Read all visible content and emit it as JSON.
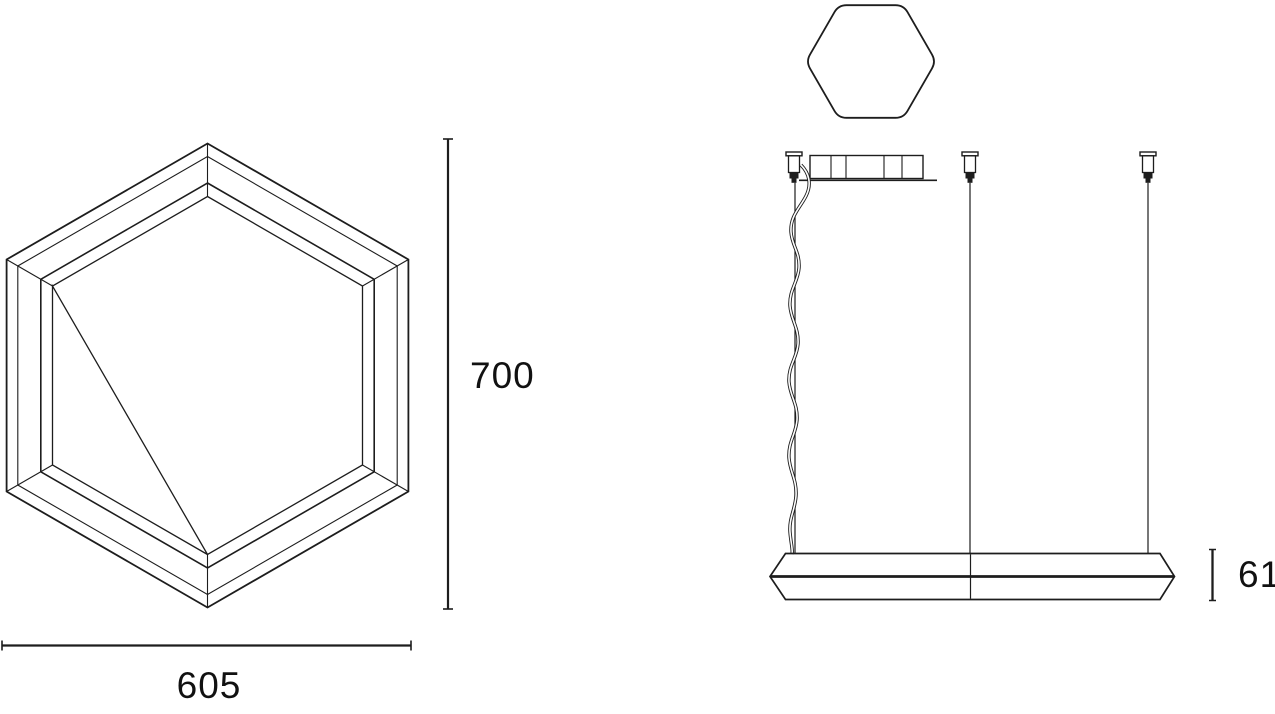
{
  "drawing": {
    "front_view": {
      "height_dimension": "700",
      "width_dimension": "605"
    },
    "side_view": {
      "profile_height_dimension": "61"
    }
  },
  "colors": {
    "line": "#1d1d1d",
    "text": "#111111",
    "background": "#ffffff"
  }
}
